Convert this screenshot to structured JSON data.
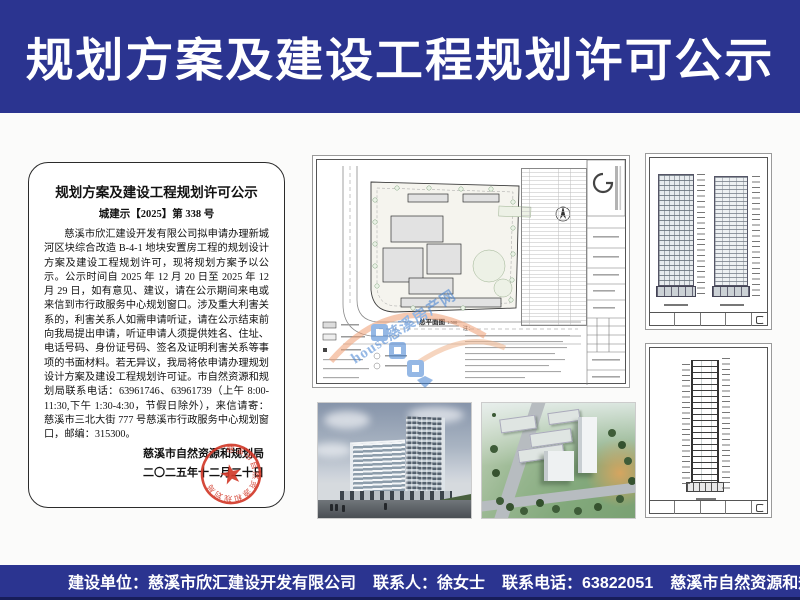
{
  "header": {
    "title": "规划方案及建设工程规划许可公示"
  },
  "notice": {
    "title": "规划方案及建设工程规划许可公示",
    "doc_number": "城建示【2025】第 338 号",
    "body": "慈溪市欣汇建设开发有限公司拟申请办理新城河区块综合改造 B-4-1 地块安置房工程的规划设计方案及建设工程规划许可，现将规划方案予以公示。公示时间自 2025 年 12 月 20 日至 2025 年 12 月 29 日，如有意见、建议，请在公示期间来电或来信到市行政服务中心规划窗口。涉及重大利害关系的，利害关系人如需申请听证，请在公示结束前向我局提出申请，听证申请人须提供姓名、住址、电话号码、身份证号码、签名及证明利害关系等事项的书面材料。若无异议，我局将依申请办理规划设计方案及建设工程规划许可证。市自然资源和规划局联系电话：63961746、63961739（上午 8:00-11:30,下午 1:30-4:30，节假日除外），来信请寄：慈溪市三北大街 777 号慈溪市行政服务中心规划窗口，邮编：315300。",
    "signature": "慈溪市自然资源和规划局",
    "date": "二〇二五年十二月二十日",
    "seal_text": "慈溪市自然资源和规划局"
  },
  "site_plan": {
    "title": "总平面图",
    "scale": "1:500",
    "notes_label": "注：",
    "watermark_text": "house慈溪房产网"
  },
  "footer": {
    "items": [
      "建设单位：慈溪市欣汇建设开发有限公司",
      "联系人：徐女士",
      "联系电话：63822051",
      "慈溪市自然资源和规划局监制",
      "2025年12月20日"
    ]
  },
  "colors": {
    "banner_blue": "#2b3490",
    "banner_dark_edge": "#171d5a",
    "seal_red": "#d23a2a",
    "watermark_blue": "#3f7fd1",
    "watermark_orange": "#f09d72"
  }
}
